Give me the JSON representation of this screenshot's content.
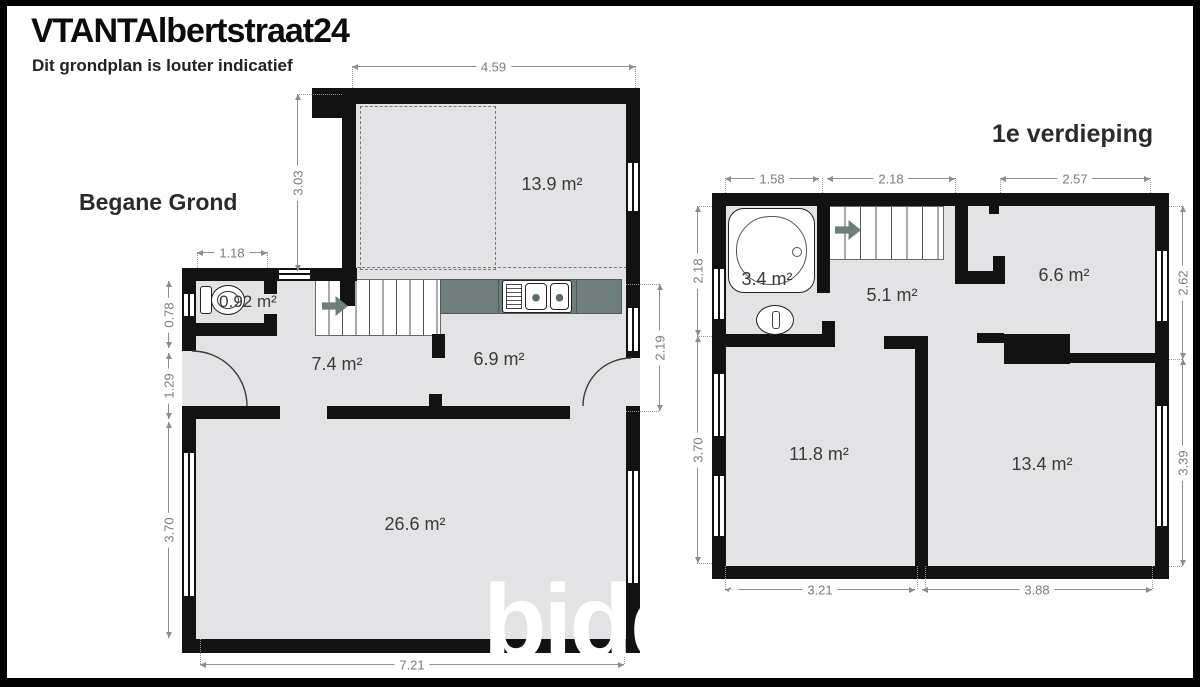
{
  "header": {
    "title": "VTANTAlbertstraat24",
    "subtitle": "Dit grondplan is louter indicatief"
  },
  "watermark": {
    "text": "biddit"
  },
  "colors": {
    "wall": "#121212",
    "floor": "#e3e3e6",
    "counter": "#6e7e7c",
    "dim": "#8d8d8d",
    "label": "#3a3a3a"
  },
  "ground_floor": {
    "label": "Begane Grond",
    "rooms": [
      {
        "name": "top-room",
        "area": "13.9 m²"
      },
      {
        "name": "wc",
        "area": "0.92 m²"
      },
      {
        "name": "hallway",
        "area": "7.4 m²"
      },
      {
        "name": "kitchen",
        "area": "6.9 m²"
      },
      {
        "name": "living-room",
        "area": "26.6 m²"
      }
    ],
    "dimensions": {
      "top_width": "4.59",
      "top_room_height": "3.03",
      "wc_width": "1.18",
      "wc_height": "0.78",
      "hall_height": "1.29",
      "living_height": "3.70",
      "kitchen_height": "2.19",
      "bottom_width": "7.21"
    }
  },
  "first_floor": {
    "label": "1e verdieping",
    "rooms": [
      {
        "name": "bathroom",
        "area": "3.4 m²"
      },
      {
        "name": "landing",
        "area": "5.1 m²"
      },
      {
        "name": "front-room",
        "area": "6.6 m²"
      },
      {
        "name": "bedroom-left",
        "area": "11.8 m²"
      },
      {
        "name": "bedroom-right",
        "area": "13.4 m²"
      }
    ],
    "dimensions": {
      "top_left": "1.58",
      "top_middle": "2.18",
      "top_right": "2.57",
      "left_upper": "2.18",
      "left_lower": "3.70",
      "right_upper": "2.62",
      "right_lower": "3.39",
      "bottom_left": "3.21",
      "bottom_right": "3.88"
    }
  }
}
